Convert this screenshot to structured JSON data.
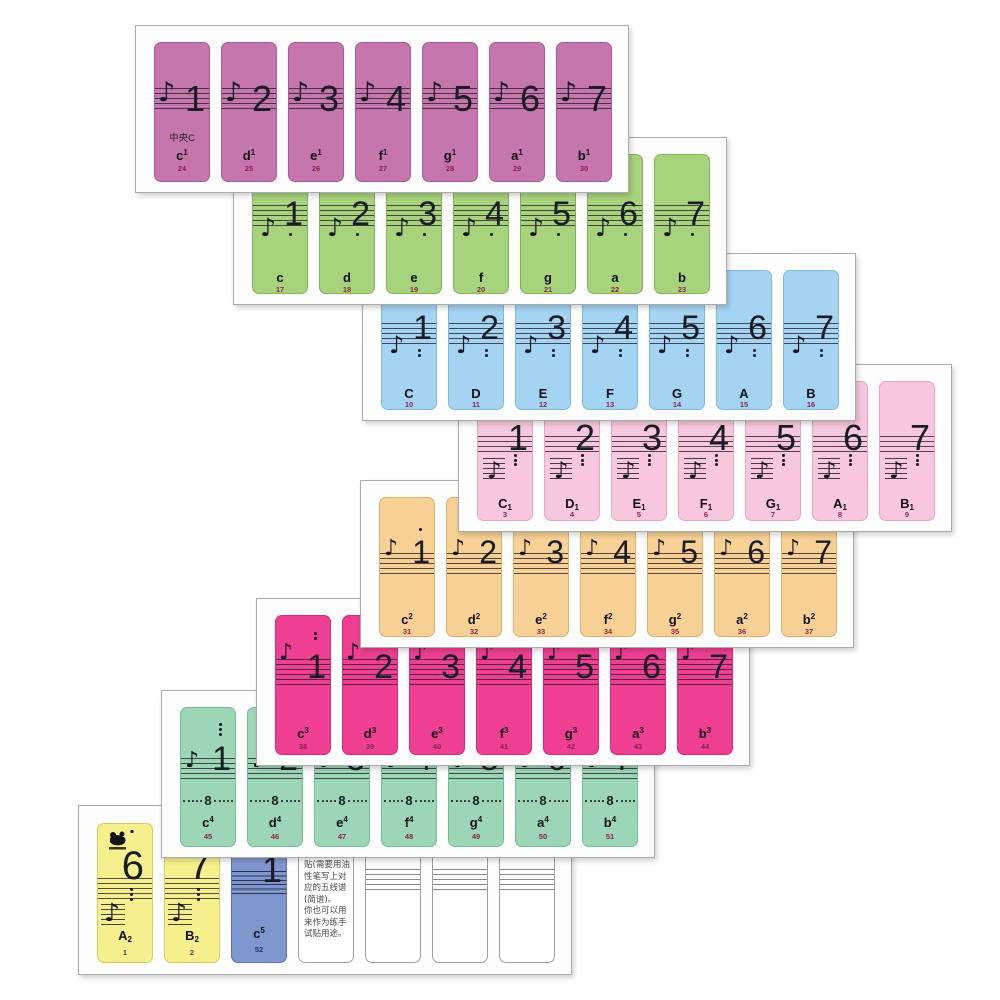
{
  "page": {
    "description": "piano keyboard note sticker sheets",
    "background": "#ffffff"
  },
  "icons": {
    "note_glyph": "♪",
    "logo": "panda-brand-logo"
  },
  "sheets": [
    {
      "name": "octave-one-lined",
      "color": "#c576ad",
      "border": "#a65c92",
      "variant": "v1",
      "script_pos": "sup",
      "stickers": [
        {
          "number": "1",
          "extra": "中央C",
          "label": "c",
          "script": "1",
          "key": "24"
        },
        {
          "number": "2",
          "label": "d",
          "script": "1",
          "key": "25"
        },
        {
          "number": "3",
          "label": "e",
          "script": "1",
          "key": "26"
        },
        {
          "number": "4",
          "label": "f",
          "script": "1",
          "key": "27"
        },
        {
          "number": "5",
          "label": "g",
          "script": "1",
          "key": "28"
        },
        {
          "number": "6",
          "label": "a",
          "script": "1",
          "key": "29"
        },
        {
          "number": "7",
          "label": "b",
          "script": "1",
          "key": "30"
        }
      ]
    },
    {
      "name": "octave-small",
      "color": "#a7d37d",
      "border": "#82b158",
      "variant": "v2",
      "dots_below": 1,
      "stickers": [
        {
          "number": "1",
          "label": "c",
          "key": "17"
        },
        {
          "number": "2",
          "label": "d",
          "key": "18"
        },
        {
          "number": "3",
          "label": "e",
          "key": "19"
        },
        {
          "number": "4",
          "label": "f",
          "key": "20"
        },
        {
          "number": "5",
          "label": "g",
          "key": "21"
        },
        {
          "number": "6",
          "label": "a",
          "key": "22"
        },
        {
          "number": "7",
          "label": "b",
          "key": "23"
        }
      ]
    },
    {
      "name": "octave-great",
      "color": "#a5d4f2",
      "border": "#7cb8e0",
      "variant": "v3",
      "dots_below": 2,
      "stickers": [
        {
          "number": "1",
          "label": "C",
          "key": "10"
        },
        {
          "number": "2",
          "label": "D",
          "key": "11"
        },
        {
          "number": "3",
          "label": "E",
          "key": "12"
        },
        {
          "number": "4",
          "label": "F",
          "key": "13"
        },
        {
          "number": "5",
          "label": "G",
          "key": "14"
        },
        {
          "number": "6",
          "label": "A",
          "key": "15"
        },
        {
          "number": "7",
          "label": "B",
          "key": "16"
        }
      ]
    },
    {
      "name": "octave-contra",
      "color": "#f7c8dc",
      "border": "#e8a6c2",
      "variant": "v4",
      "dots_below": 3,
      "script_pos": "sub",
      "stickers": [
        {
          "number": "1",
          "label": "C",
          "script": "1",
          "key": "3"
        },
        {
          "number": "2",
          "label": "D",
          "script": "1",
          "key": "4"
        },
        {
          "number": "3",
          "label": "E",
          "script": "1",
          "key": "5"
        },
        {
          "number": "4",
          "label": "F",
          "script": "1",
          "key": "6"
        },
        {
          "number": "5",
          "label": "G",
          "script": "1",
          "key": "7"
        },
        {
          "number": "6",
          "label": "A",
          "script": "1",
          "key": "8"
        },
        {
          "number": "7",
          "label": "B",
          "script": "1",
          "key": "9"
        }
      ]
    },
    {
      "name": "octave-two-lined",
      "color": "#f6d095",
      "border": "#ddb06e",
      "variant": "v5",
      "dots_above": 1,
      "script_pos": "sup",
      "stickers": [
        {
          "number": "1",
          "label": "c",
          "script": "2",
          "key": "31"
        },
        {
          "number": "2",
          "label": "d",
          "script": "2",
          "key": "32"
        },
        {
          "number": "3",
          "label": "e",
          "script": "2",
          "key": "33"
        },
        {
          "number": "4",
          "label": "f",
          "script": "2",
          "key": "34"
        },
        {
          "number": "5",
          "label": "g",
          "script": "2",
          "key": "35"
        },
        {
          "number": "6",
          "label": "a",
          "script": "2",
          "key": "36"
        },
        {
          "number": "7",
          "label": "b",
          "script": "2",
          "key": "37"
        }
      ]
    },
    {
      "name": "octave-three-lined",
      "color": "#ee3f92",
      "border": "#d22b79",
      "variant": "v6",
      "dots_above": 2,
      "script_pos": "sup",
      "stickers": [
        {
          "number": "1",
          "label": "c",
          "script": "3",
          "key": "38"
        },
        {
          "number": "2",
          "label": "d",
          "script": "3",
          "key": "39"
        },
        {
          "number": "3",
          "label": "e",
          "script": "3",
          "key": "40"
        },
        {
          "number": "4",
          "label": "f",
          "script": "3",
          "key": "41"
        },
        {
          "number": "5",
          "label": "g",
          "script": "3",
          "key": "42"
        },
        {
          "number": "6",
          "label": "a",
          "script": "3",
          "key": "43"
        },
        {
          "number": "7",
          "label": "b",
          "script": "3",
          "key": "44"
        }
      ]
    },
    {
      "name": "octave-four-lined",
      "color": "#9dd6b7",
      "border": "#72bf97",
      "variant": "v7",
      "dots_above": 3,
      "script_pos": "sup",
      "ottava_label": "8",
      "stickers": [
        {
          "number": "1",
          "label": "c",
          "script": "4",
          "key": "45"
        },
        {
          "number": "2",
          "label": "d",
          "script": "4",
          "key": "46"
        },
        {
          "number": "3",
          "label": "e",
          "script": "4",
          "key": "47"
        },
        {
          "number": "4",
          "label": "f",
          "script": "4",
          "key": "48"
        },
        {
          "number": "5",
          "label": "g",
          "script": "4",
          "key": "49"
        },
        {
          "number": "6",
          "label": "a",
          "script": "4",
          "key": "50"
        },
        {
          "number": "7",
          "label": "b",
          "script": "4",
          "key": "51"
        }
      ]
    },
    {
      "name": "bass-extras-and-blanks",
      "stickers": [
        {
          "variant": "v8y",
          "color": "#f5f08d",
          "border": "#d6cb5f",
          "number": "6",
          "dots_below": 3,
          "label": "A",
          "script": "2",
          "script_pos": "sub",
          "key": "1",
          "logo": true
        },
        {
          "variant": "v8y",
          "color": "#f5f08d",
          "border": "#d6cb5f",
          "number": "7",
          "dots_below": 3,
          "label": "B",
          "script": "2",
          "script_pos": "sub",
          "key": "2"
        },
        {
          "variant": "v8b",
          "color": "#8096cf",
          "border": "#5d74b4",
          "number": "1",
          "label": "c",
          "script": "5",
          "script_pos": "sup",
          "key": "52"
        },
        {
          "variant": "v8t",
          "color": "#ffffff",
          "border": "#9f9f9f",
          "lines": [
            "贴(需要用油",
            "性笔写上对",
            "应的五线谱",
            "(简谱)。",
            "你也可以用",
            "来作为练手",
            "试贴用途。"
          ]
        },
        {
          "variant": "v8k",
          "color": "#ffffff",
          "border": "#9f9f9f"
        },
        {
          "variant": "v8k",
          "color": "#ffffff",
          "border": "#9f9f9f"
        },
        {
          "variant": "v8k",
          "color": "#ffffff",
          "border": "#9f9f9f"
        }
      ]
    }
  ]
}
